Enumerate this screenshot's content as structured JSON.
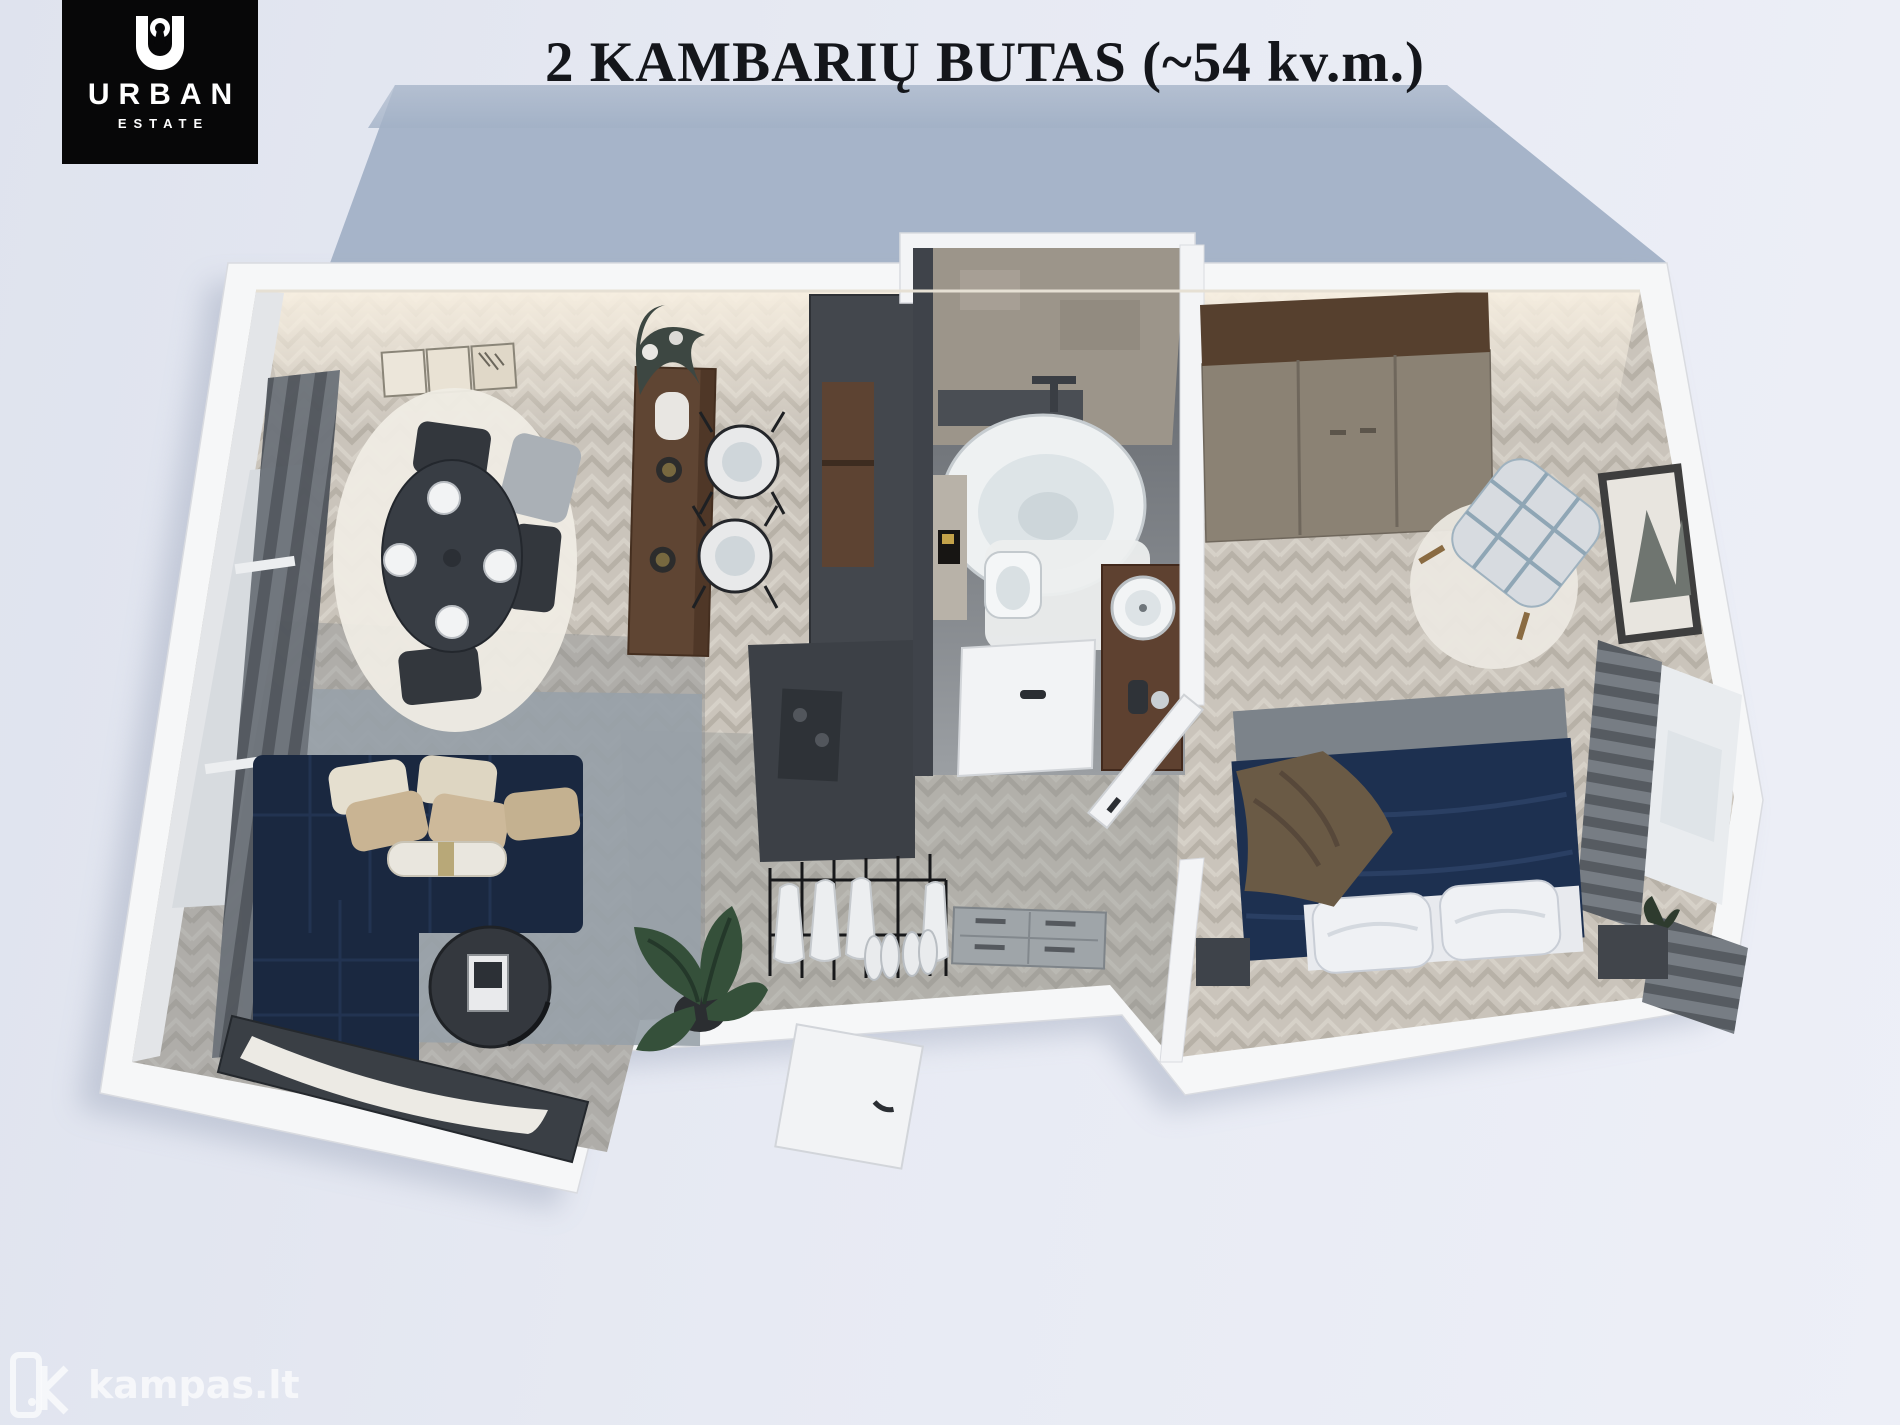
{
  "header": {
    "title": "2 KAMBARIŲ BUTAS (~54 kv.m.)"
  },
  "logo": {
    "brand_top": "URBAN",
    "brand_bottom": "ESTATE",
    "icon": "keyhole-u-icon"
  },
  "watermark": {
    "text": "kampas.lt",
    "icon": "kampas-house-icon"
  },
  "colors": {
    "background_shadow_top": "#b7c2d3",
    "background_shadow_bottom": "#a2b1c6",
    "outer_wall": "#f6f7f8",
    "floor_base": "#cac4bb",
    "floor_plank_line": "#b7b1a7",
    "living_rug": "#98a1a8",
    "sofa_navy": "#1a2840",
    "coffee_table": "#34383e",
    "tv_console": "#3a3f45",
    "dining_table": "#383d44",
    "dining_rug": "#efece4",
    "bar_wood": "#5f4533",
    "kitchen_unit": "#43474d",
    "kitchen_wood": "#5d4332",
    "bath_concrete": "#9c958a",
    "bath_floor": "#72767b",
    "tub_white": "#eef1f2",
    "vanity_wood": "#5e4130",
    "wardrobe_top": "#56402e",
    "wardrobe_doors": "#8b8274",
    "bed_navy": "#1d3050",
    "bed_throw": "#6a5a45",
    "curtain_dark": "#5a5f66",
    "plant_green": "#35503a",
    "title_color": "#14161b"
  }
}
